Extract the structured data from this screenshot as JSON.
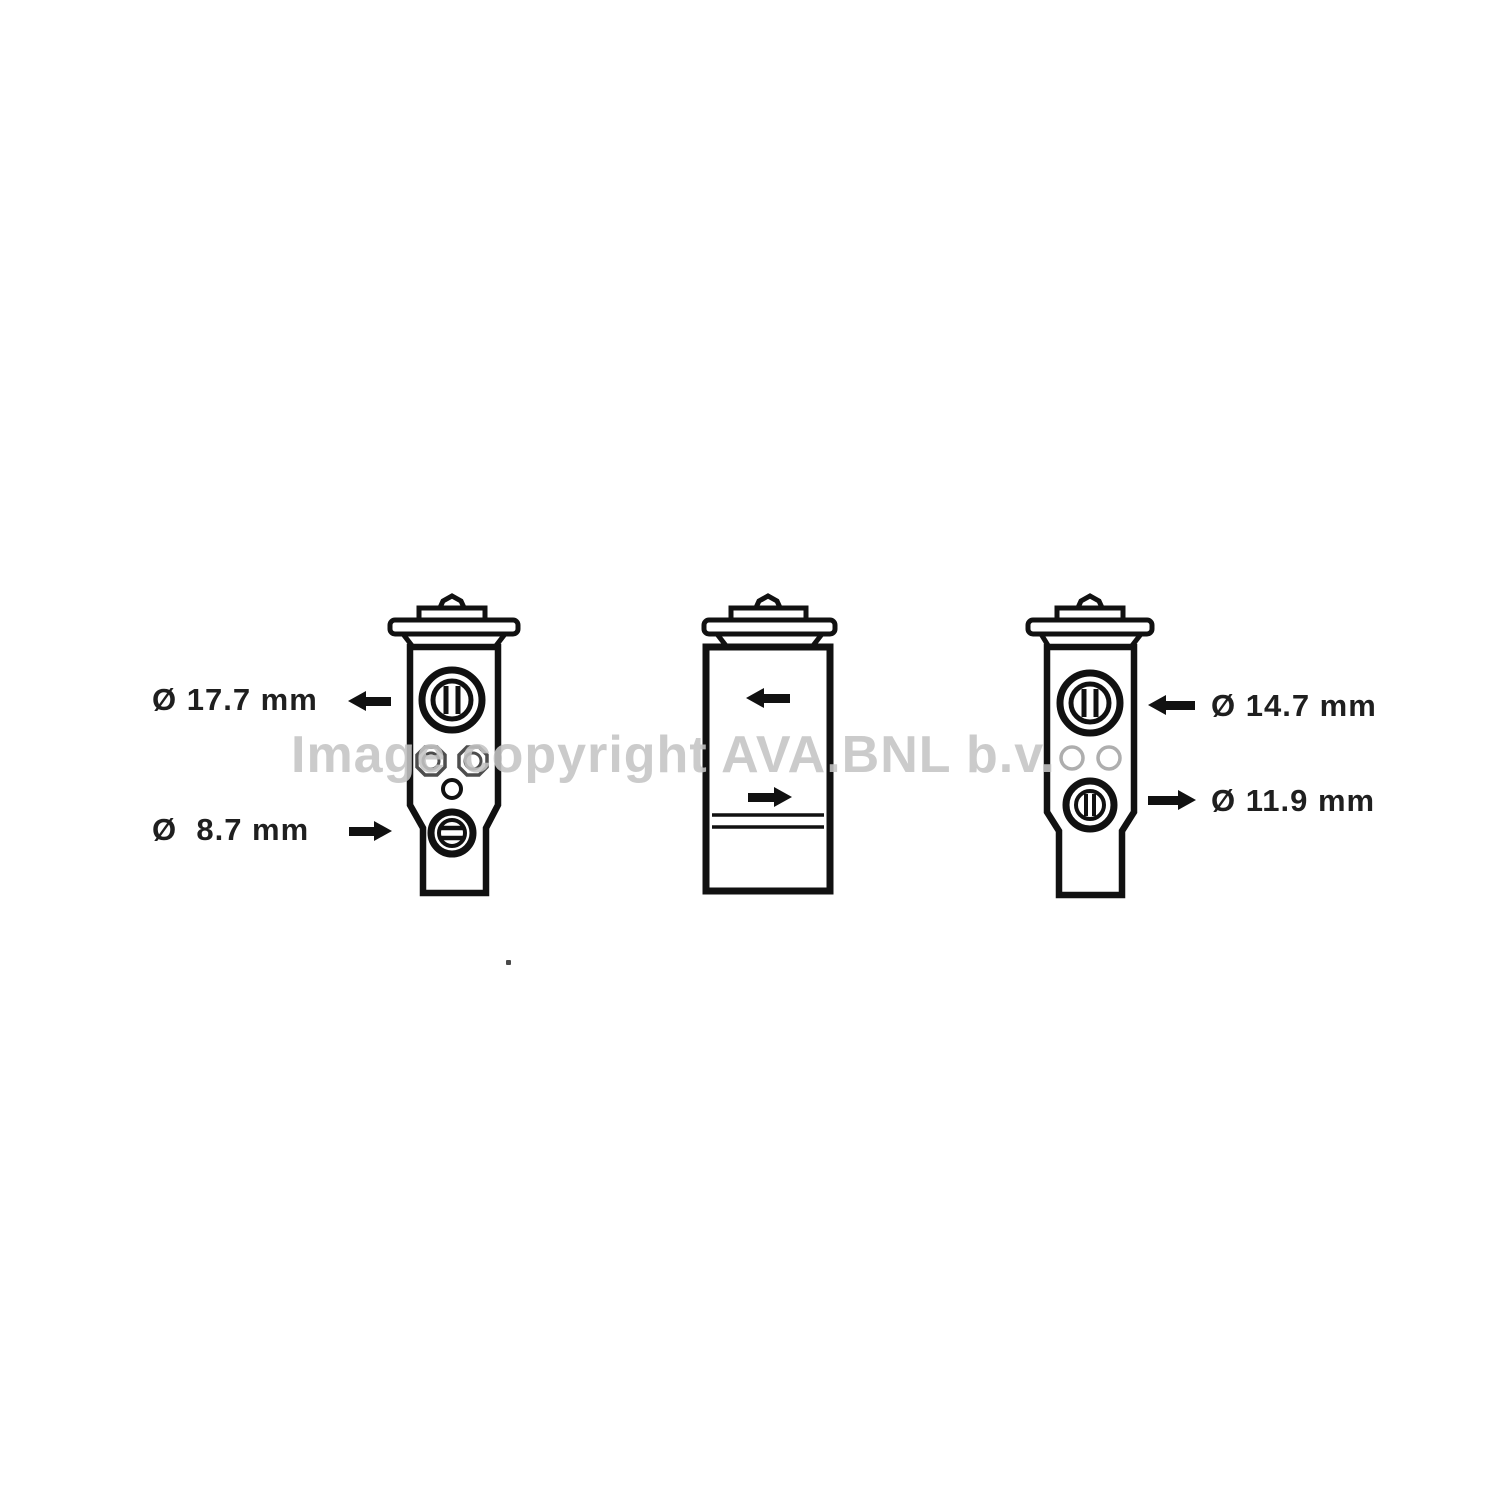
{
  "page": {
    "background_color": "#ffffff",
    "line_color": "#111111",
    "watermark_color": "#c4c4c4"
  },
  "watermark": {
    "text": "Image copyright AVA.BNL b.v."
  },
  "diagram": {
    "description": "expansion-valve-three-orthographic-views",
    "views": [
      {
        "name": "left-view-port-face",
        "features": [
          "cap",
          "large-port-circle",
          "two-hex-nuts",
          "small-pilot-hole",
          "lower-port-circle",
          "chamfered-lower-body"
        ]
      },
      {
        "name": "middle-view-side-face",
        "features": [
          "cap",
          "inlet-arrow-left",
          "outlet-arrow-right",
          "two-horizontal-lines"
        ]
      },
      {
        "name": "right-view-port-face",
        "features": [
          "cap",
          "large-port-circle",
          "two-small-holes",
          "lower-port-circle",
          "chamfered-lower-body"
        ]
      }
    ]
  },
  "labels": {
    "dim_17_7": "Ø 17.7 mm",
    "dim_8_7": "Ø  8.7 mm",
    "dim_14_7": "Ø 14.7 mm",
    "dim_11_9": "Ø 11.9 mm"
  }
}
